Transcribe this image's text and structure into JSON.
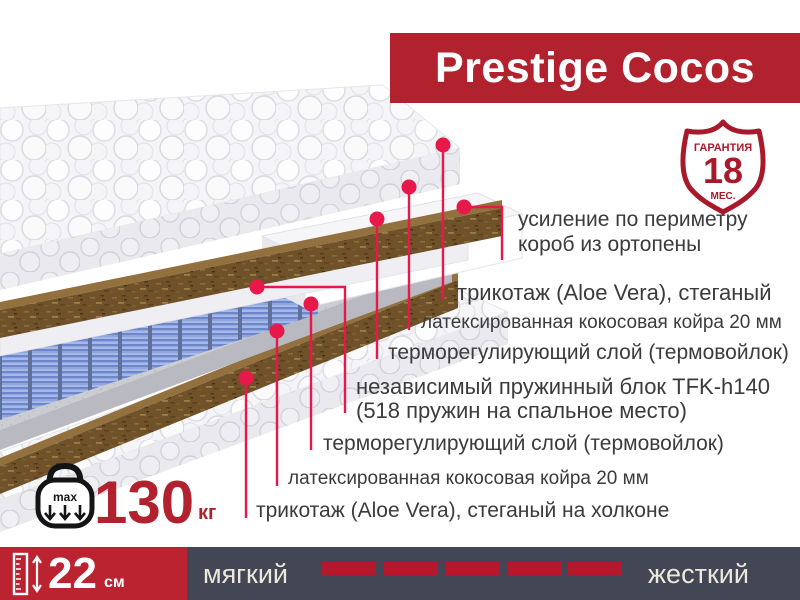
{
  "banner": {
    "title": "Prestige Cocos",
    "color": "#b2212e"
  },
  "badge": {
    "top_label": "ГАРАНТИЯ",
    "number": "18",
    "bottom_label": "МЕС."
  },
  "callouts": [
    {
      "text": "усиление по периметру\nкороб из ортопены"
    },
    {
      "text": "трикотаж (Aloe Vera), стеганый"
    },
    {
      "text": "латексированная кокосовая койра 20 мм"
    },
    {
      "text": "терморегулирующий слой (термовойлок)"
    },
    {
      "text": "независимый пружинный блок TFK-h140\n(518 пружин на спальное место)"
    },
    {
      "text": "терморегулирующий слой (термовойлок)"
    },
    {
      "text": "латексированная кокосовая койра 20 мм"
    },
    {
      "text": "трикотаж (Aloe Vera), стеганый на холконе"
    }
  ],
  "weight": {
    "icon_label": "max",
    "value": "130",
    "unit": "кг"
  },
  "height": {
    "value": "22",
    "unit": "см"
  },
  "firmness": {
    "soft_label": "мягкий",
    "hard_label": "жесткий",
    "dash_count": 5
  },
  "colors": {
    "accent_red": "#b2212e",
    "callout_line": "#e8184b",
    "bar_slate": "#434654",
    "coir_brown": "#6f5229",
    "spring_blue": "#8ea6dd"
  }
}
